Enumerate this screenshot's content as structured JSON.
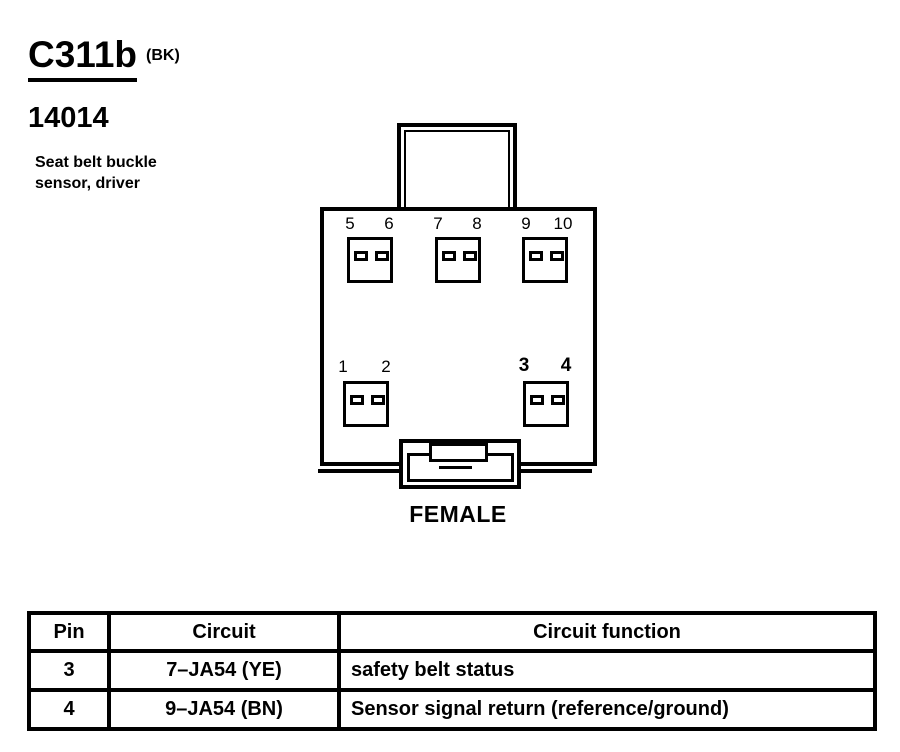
{
  "colors": {
    "paper": "#ffffff",
    "ink": "#000000"
  },
  "header": {
    "connector_id": "C311b",
    "connector_color_code": "(BK)",
    "part_number": "14014",
    "description": "Seat belt buckle sensor, driver"
  },
  "diagram": {
    "gender_label": "FEMALE",
    "pins": {
      "p1": "1",
      "p2": "2",
      "p3": "3",
      "p4": "4",
      "p5": "5",
      "p6": "6",
      "p7": "7",
      "p8": "8",
      "p9": "9",
      "p10": "10"
    },
    "cavity_groups": [
      {
        "row": "top",
        "pins": [
          "5",
          "6"
        ]
      },
      {
        "row": "top",
        "pins": [
          "7",
          "8"
        ]
      },
      {
        "row": "top",
        "pins": [
          "9",
          "10"
        ]
      },
      {
        "row": "bottom",
        "pins": [
          "1",
          "2"
        ]
      },
      {
        "row": "bottom",
        "pins": [
          "3",
          "4"
        ]
      }
    ]
  },
  "table": {
    "headers": [
      "Pin",
      "Circuit",
      "Circuit function"
    ],
    "rows": [
      {
        "pin": "3",
        "circuit": "7–JA54 (YE)",
        "function": "safety belt status"
      },
      {
        "pin": "4",
        "circuit": "9–JA54 (BN)",
        "function": "Sensor signal return (reference/ground)"
      }
    ]
  }
}
